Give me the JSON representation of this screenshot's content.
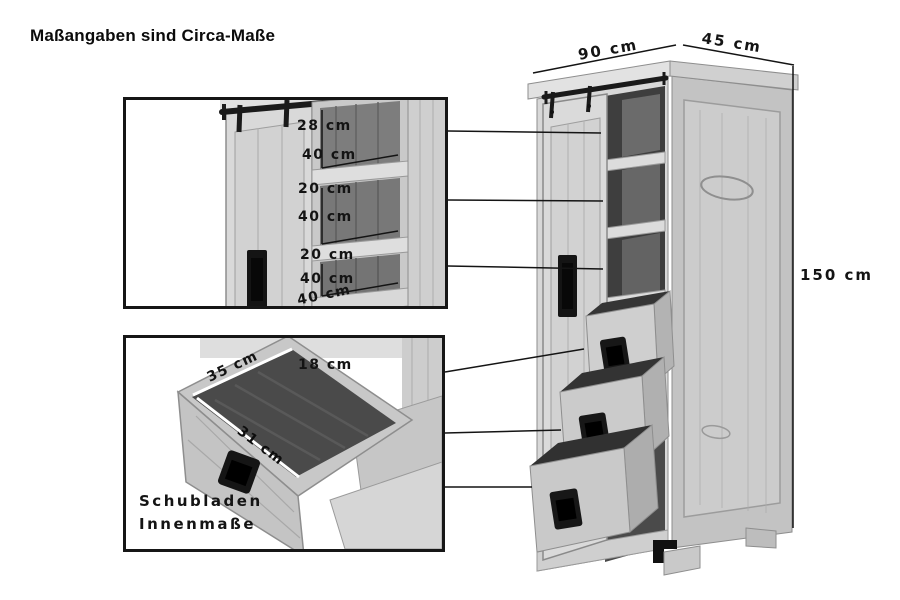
{
  "title": "Maßangaben sind Circa-Maße",
  "overall_dimensions": {
    "width": "90 cm",
    "depth": "45 cm",
    "height": "150 cm"
  },
  "shelf_inset": {
    "compartments": [
      {
        "height": "28 cm",
        "depth": "40 cm"
      },
      {
        "height": "20 cm",
        "depth": "40 cm"
      },
      {
        "height": "20 cm",
        "depth": "40 cm"
      }
    ],
    "bottom_depth": "40 cm"
  },
  "drawer_inset": {
    "inner_width": "35 cm",
    "inner_height": "18 cm",
    "inner_depth": "31 cm",
    "caption": [
      "Schubladen",
      "Innenmaße"
    ]
  },
  "colors": {
    "background": "#ffffff",
    "line": "#141414",
    "hardware_black": "#1a1a1a",
    "wood_light": "#d8d8d8",
    "wood_mid": "#c3c3c3",
    "interior_dark": "#3e3e3e"
  }
}
